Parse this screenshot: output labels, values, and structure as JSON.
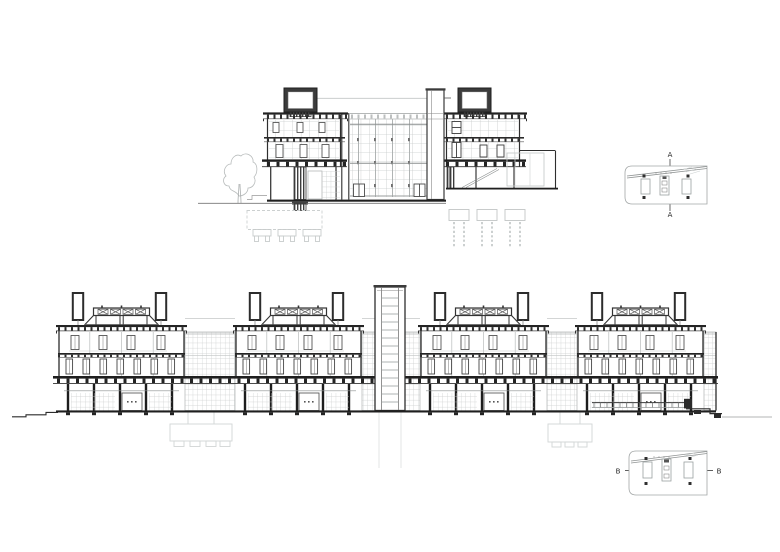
{
  "sheet": {
    "background": "#ffffff",
    "type": "architectural-sections-drawing"
  },
  "colors": {
    "ink": "#2b2b2b",
    "ink_soft": "#555555",
    "dark_fill": "#3b3b3b",
    "ground_ink": "#1f1f1f",
    "glazing_gray": "#c9cbcb",
    "faint_gray": "#d2d5d5"
  },
  "section_a": {
    "markers": {
      "top": "A",
      "bottom": "A"
    }
  },
  "section_b": {
    "markers": {
      "left": "B",
      "right": "B"
    }
  }
}
